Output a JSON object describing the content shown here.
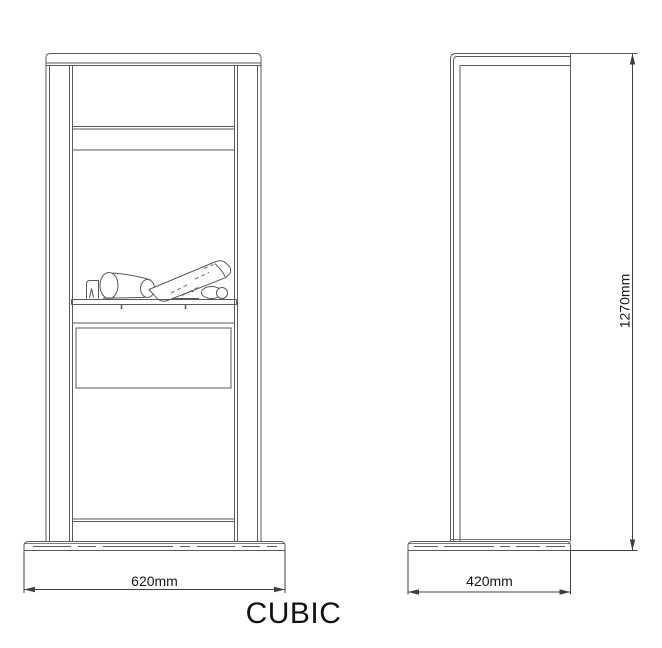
{
  "drawing": {
    "product_title": "CUBIC",
    "front_view": {
      "width_dimension": "620mm"
    },
    "side_view": {
      "depth_dimension": "420mm",
      "height_dimension": "1270mm"
    }
  },
  "colors": {
    "line": "#5a5a5a",
    "dimension_line": "#3f3f3f",
    "text": "#161616",
    "background": "#ffffff"
  }
}
